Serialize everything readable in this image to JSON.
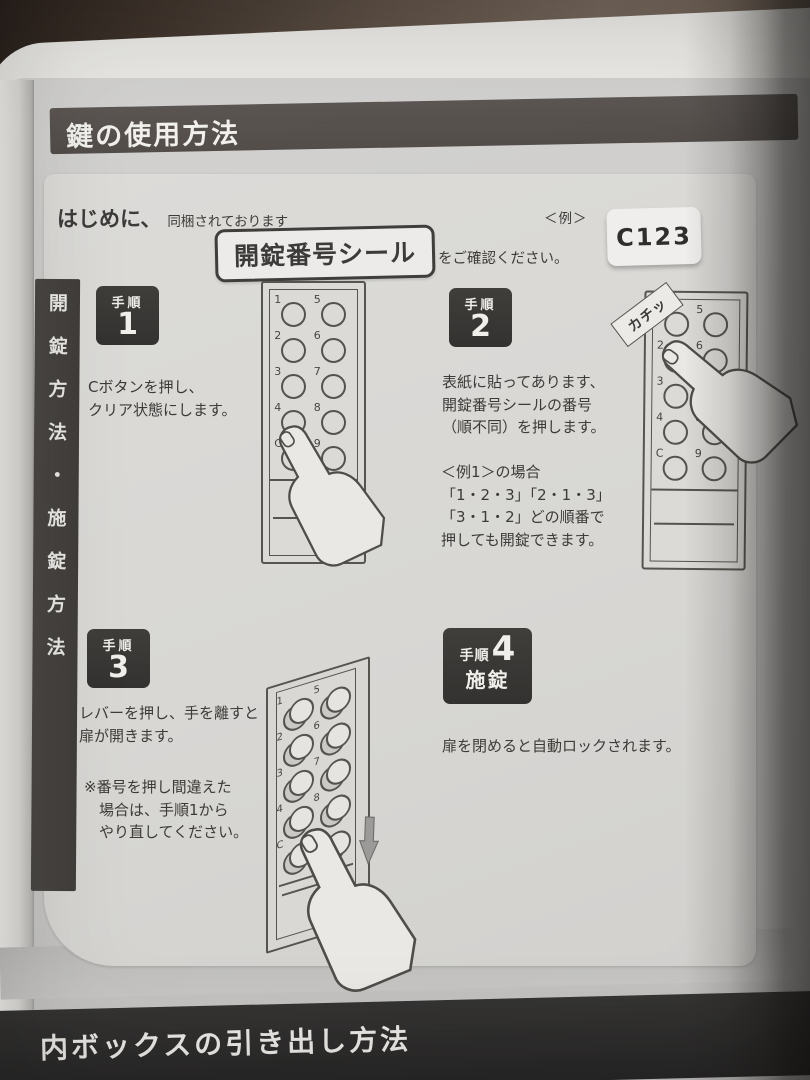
{
  "header": {
    "title": "鍵の使用方法"
  },
  "footer": {
    "title": "内ボックスの引き出し方法"
  },
  "sidebar": {
    "vertical_label": "開錠方法・施錠方法"
  },
  "intro": {
    "lead": "はじめに、",
    "lead_note": "同梱されております",
    "sticker_label": "開錠番号シール",
    "confirm": "をご確認ください。",
    "example_caption": "＜例＞",
    "example_code": "C123"
  },
  "steps": {
    "s1": {
      "badge": "手順",
      "number": "1",
      "line1": "Cボタンを押し、",
      "line2": "クリア状態にします。"
    },
    "s2": {
      "badge": "手順",
      "number": "2",
      "line1": "表紙に貼ってあります、",
      "line2": "開錠番号シールの番号",
      "line3": "（順不同）を押します。",
      "ex1": "＜例1＞の場合",
      "ex2": "「1・2・3」「2・1・3」",
      "ex3": "「3・1・2」どの順番で",
      "ex4": "押しても開錠できます。"
    },
    "s3": {
      "badge": "手順",
      "number": "3",
      "line1": "レバーを押し、手を離すと",
      "line2": "扉が開きます。",
      "note1": "※番号を押し間違えた",
      "note2": "場合は、手順1から",
      "note3": "やり直してください。"
    },
    "s4": {
      "badge": "手順",
      "number": "4",
      "sub": "施錠",
      "line1": "扉を閉めると自動ロックされます。"
    }
  },
  "keypad": {
    "left": [
      "1",
      "2",
      "3",
      "4",
      "C"
    ],
    "right": [
      "5",
      "6",
      "7",
      "8",
      "9"
    ],
    "click_sound": "カチッ"
  },
  "colors": {
    "backdrop_brown": "#5d5046",
    "page_gray": "#cbcac8",
    "panel_gray": "#d8d7d4",
    "header_bar": "#57514e",
    "footer_bar": "#2e2d2c",
    "badge_dark": "#3a3836",
    "ink": "#3c3b39",
    "sticker_white": "#efeeec"
  }
}
